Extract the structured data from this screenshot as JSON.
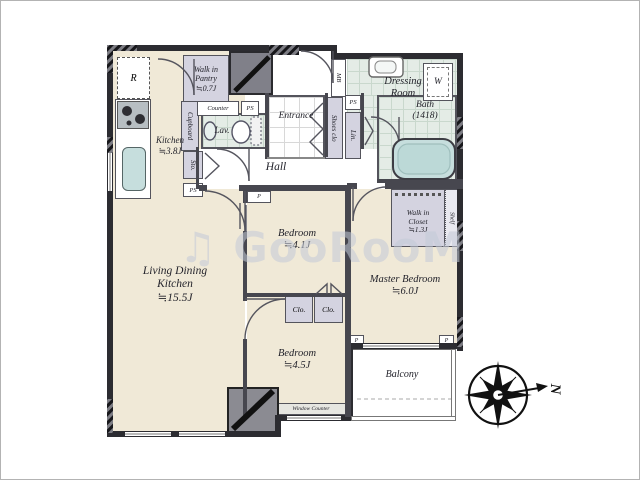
{
  "watermark": {
    "text": "♫ GooRooM"
  },
  "compass": {
    "letter": "N"
  },
  "rooms": {
    "ldk": {
      "name1": "Living Dining",
      "name2": "Kitchen",
      "size": "≒15.5J"
    },
    "kitchen": {
      "name": "Kitchen",
      "size": "≒3.8J"
    },
    "pantry": {
      "l1": "Walk in",
      "l2": "Pantry",
      "size": "≒0.7J"
    },
    "bedroom1": {
      "name": "Bedroom",
      "size": "≒4.1J"
    },
    "bedroom2": {
      "name": "Bedroom",
      "size": "≒4.5J"
    },
    "master": {
      "name": "Master Bedroom",
      "size": "≒6.0J"
    },
    "wic": {
      "l1": "Walk in",
      "l2": "Closet",
      "size": "≒1.3J"
    },
    "dressing": {
      "l1": "Dressing",
      "l2": "Room"
    },
    "bath": {
      "name": "Bath",
      "size": "(1418)"
    },
    "entrance": {
      "name": "Entrance"
    },
    "hall": {
      "name": "Hall"
    },
    "lav": {
      "name": "Lav."
    },
    "balcony": {
      "name": "Balcony"
    }
  },
  "storage": {
    "cupboard": "Cupboard",
    "sto": "Sto.",
    "shoes": "Shoes clo",
    "lin": "Lin.",
    "shelf": "Shelf",
    "clo1": "Clo.",
    "clo2": "Clo."
  },
  "fixtures": {
    "fridge": "R",
    "washer": "W",
    "meter": "MB",
    "counter": "Counter",
    "window_counter": "Window Counter"
  },
  "labels": {
    "ps": "PS",
    "p": "P"
  },
  "colors": {
    "room_cream": "#f0e9d7",
    "wet_green": "#e4ece6",
    "closet_lavender": "#d4d3e0",
    "wall_dark": "#2c2c31",
    "tub_teal": "#c6dedd"
  }
}
